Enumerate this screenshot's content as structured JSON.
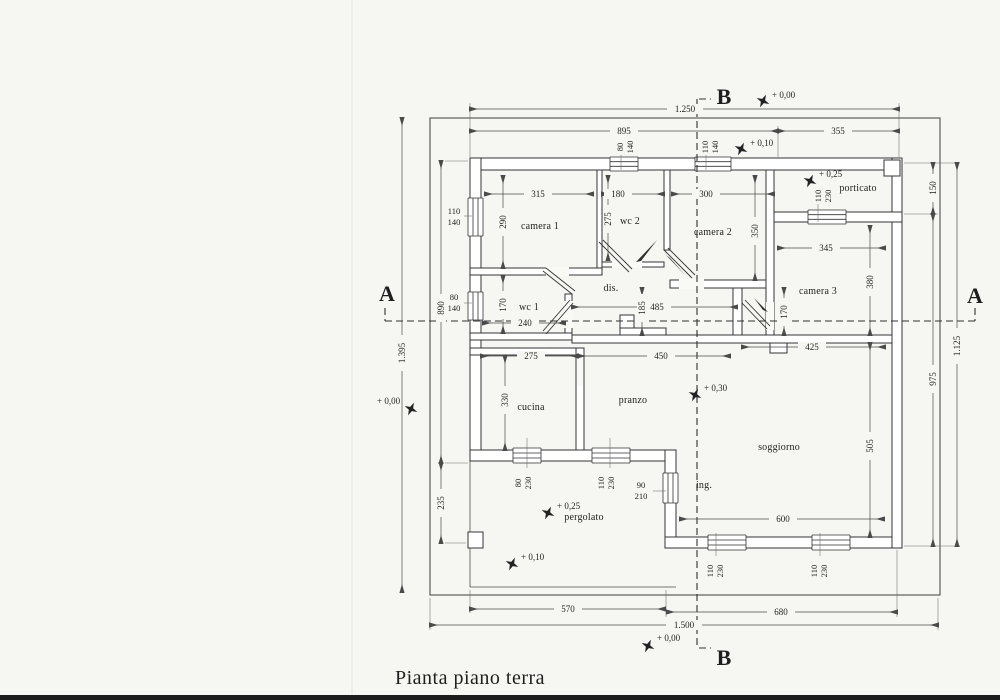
{
  "title": "Pianta piano terra",
  "colors": {
    "ink": "#2f2f2f",
    "paper": "#f6f6f2",
    "dim_line": "#4a4a4a"
  },
  "sections": {
    "a": "A",
    "b": "B"
  },
  "rooms": {
    "camera1": "camera 1",
    "wc2": "wc 2",
    "camera2": "camera 2",
    "camera3": "camera 3",
    "wc1": "wc 1",
    "dis": "dis.",
    "cucina": "cucina",
    "pranzo": "pranzo",
    "soggiorno": "soggiorno",
    "porticato": "porticato",
    "pergolato": "pergolato",
    "ingresso": "ing."
  },
  "dims": {
    "total_top": "1.250",
    "building_top": "895",
    "porch_top": "355",
    "camera1_w": "315",
    "wc2_w": "180",
    "camera2_w": "300",
    "camera3_w": "345",
    "wc1_w": "240",
    "hall_w": "485",
    "cucina_w": "275",
    "pranzo_w": "450",
    "sogg_top_w": "425",
    "sogg_w": "600",
    "bottom_left": "570",
    "bottom_right": "680",
    "total_bottom": "1.500",
    "left_total": "1.395",
    "left_building": "890",
    "left_lower": "235",
    "camera1_h": "290",
    "wc1_h": "170",
    "cucina_h": "330",
    "wc2_h": "275",
    "camera2_h": "350",
    "camera3_h": "380",
    "corridor_h": "170",
    "sogg_h": "505",
    "hall_h": "185",
    "right_porch": "150",
    "right_building": "975",
    "right_total": "1.125"
  },
  "openings": {
    "win_camera1": {
      "w": "110",
      "h": "140"
    },
    "win_wc1": {
      "w": "80",
      "h": "140"
    },
    "win_wc2": {
      "w": "80",
      "h": "140"
    },
    "win_camera2": {
      "w": "110",
      "h": "140"
    },
    "win_porticato": {
      "w": "110",
      "h": "230"
    },
    "win_cucina": {
      "w": "80",
      "h": "230"
    },
    "win_pranzo": {
      "w": "110",
      "h": "230"
    },
    "door_ingresso": {
      "w": "90",
      "h": "210"
    },
    "win_soggiorno_a": {
      "w": "110",
      "h": "230"
    },
    "win_soggiorno_b": {
      "w": "110",
      "h": "230"
    }
  },
  "elevations": {
    "site_top": "+ 0,00",
    "walk_top": "+ 0,10",
    "porticato": "+ 0,25",
    "interior": "+ 0,30",
    "pergolato": "+ 0,25",
    "garden": "+ 0,10",
    "site_bottom": "+ 0,00",
    "site_left": "+ 0,00"
  }
}
